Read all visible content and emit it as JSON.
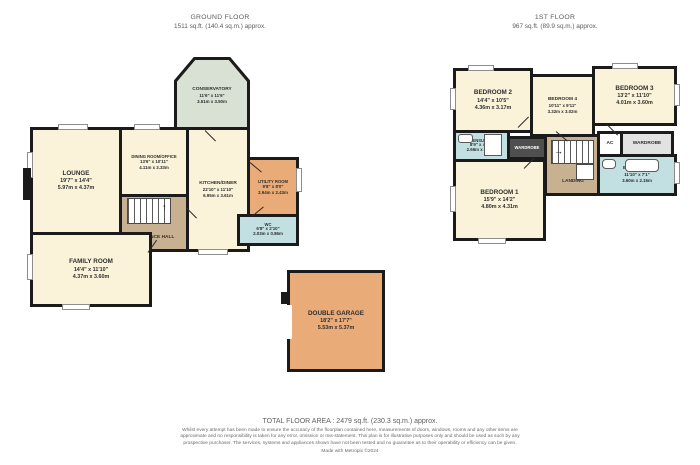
{
  "ground": {
    "title": "GROUND FLOOR",
    "area": "1511 sq.ft. (140.4 sq.m.) approx.",
    "rooms": {
      "conservatory": {
        "name": "CONSERVATORY",
        "imperial": "11'6\" x 11'6\"",
        "metric": "3.51m x 3.50m"
      },
      "lounge": {
        "name": "LOUNGE",
        "imperial": "19'7\" x 14'4\"",
        "metric": "5.97m x 4.37m"
      },
      "dining": {
        "name": "DINING ROOM/OFFICE",
        "imperial": "13'6\" x 10'11\"",
        "metric": "4.11m x 3.33m"
      },
      "kitchen": {
        "name": "KITCHEN/DINER",
        "imperial": "22'10\" x 11'10\"",
        "metric": "6.95m x 3.61m"
      },
      "utility": {
        "name": "UTILITY ROOM",
        "imperial": "9'8\" x 8'0\"",
        "metric": "2.94m x 2.43m"
      },
      "wc": {
        "name": "WC",
        "imperial": "6'8\" x 2'10\"",
        "metric": "2.03m x 0.86m"
      },
      "entrance_hall": {
        "name": "ENTRANCE HALL"
      },
      "family": {
        "name": "FAMILY ROOM",
        "imperial": "14'4\" x 11'10\"",
        "metric": "4.37m x 3.60m"
      },
      "garage": {
        "name": "DOUBLE GARAGE",
        "imperial": "18'2\" x 17'7\"",
        "metric": "5.53m x 5.37m"
      }
    }
  },
  "first": {
    "title": "1ST FLOOR",
    "area": "967 sq.ft. (89.9 sq.m.) approx.",
    "rooms": {
      "bedroom2": {
        "name": "BEDROOM 2",
        "imperial": "14'4\" x 10'5\"",
        "metric": "4.36m x 3.17m"
      },
      "bedroom4": {
        "name": "BEDROOM 4",
        "imperial": "10'11\" x 9'11\"",
        "metric": "3.32m x 3.02m"
      },
      "bedroom3": {
        "name": "BEDROOM 3",
        "imperial": "13'2\" x 11'10\"",
        "metric": "4.01m x 3.60m"
      },
      "ensuite": {
        "name": "ENSUITE",
        "imperial": "8'9\" x 4'10\"",
        "metric": "2.66m x 1.48m"
      },
      "wardrobe_hall": {
        "name": "WARDROBE"
      },
      "landing": {
        "name": "LANDING"
      },
      "ac": {
        "name": "AC"
      },
      "wardrobe": {
        "name": "WARDROBE"
      },
      "bathroom": {
        "name": "BATHROOM",
        "imperial": "11'10\" x 7'1\"",
        "metric": "3.60m x 2.15m"
      },
      "bedroom1": {
        "name": "BEDROOM 1",
        "imperial": "15'9\" x 14'2\"",
        "metric": "4.80m x 4.31m"
      }
    }
  },
  "footer": {
    "total_area": "TOTAL FLOOR AREA : 2479 sq.ft. (230.3 sq.m.) approx.",
    "disclaimer": "Whilst every attempt has been made to ensure the accuracy of the floorplan contained here, measurements of doors, windows, rooms and any other items are approximate and no responsibility is taken for any error, omission or mis-statement. This plan is for illustrative purposes only and should be used as such by any prospective purchaser. The services, systems and appliances shown have not been tested and no guarantee as to their operability or efficiency can be given.",
    "credit": "Made with Metropix ©2024"
  },
  "colors": {
    "wall": "#1b1b1b",
    "room_cream": "#faf3d9",
    "conservatory_green": "#d8e1d3",
    "hall_tan": "#c8b190",
    "utility_orange": "#e9ab78",
    "wet_blue": "#c2e0e2",
    "wardrobe_dark": "#4f4f4f",
    "wardrobe_grey": "#e2e2e2"
  }
}
